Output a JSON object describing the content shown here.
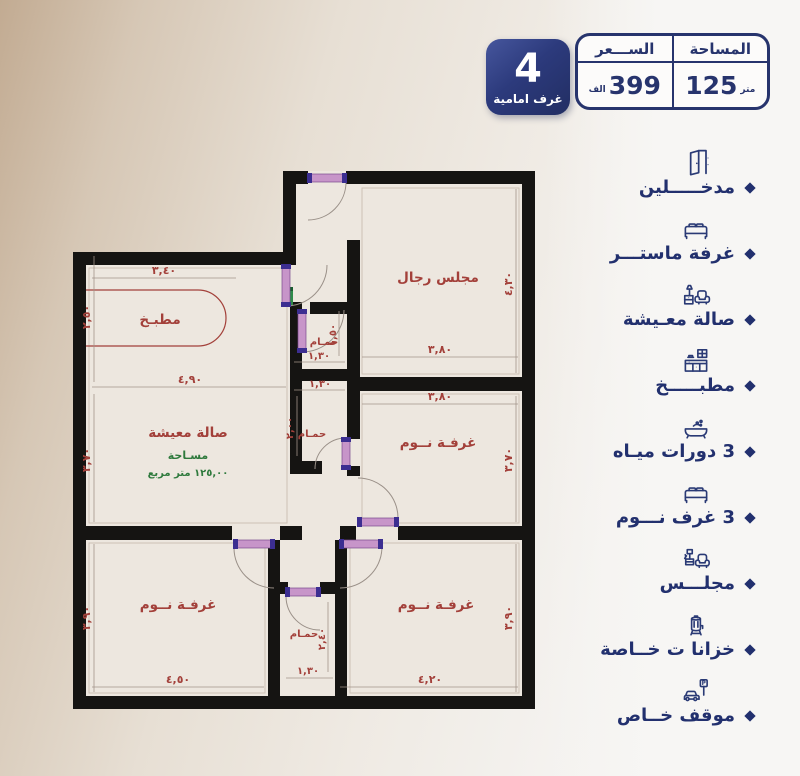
{
  "header": {
    "area": {
      "label": "المساحة",
      "value": "125",
      "unit": "متر"
    },
    "price": {
      "label": "الســـعر",
      "value": "399",
      "unit": "الف"
    },
    "badge": {
      "number": "4",
      "label": "غرف امامية"
    }
  },
  "features": {
    "items": [
      {
        "icon": "door-icon",
        "label": "مدخـــــلين"
      },
      {
        "icon": "bed-icon",
        "label": "غرفة ماستـــر"
      },
      {
        "icon": "living-room-icon",
        "label": "صالة معـيشة"
      },
      {
        "icon": "kitchen-icon",
        "label": "مطبـــــخ"
      },
      {
        "icon": "bathtub-icon",
        "label": "3 دورات ميـاه"
      },
      {
        "icon": "bed-icon",
        "label": "3 غرف نـــوم"
      },
      {
        "icon": "majlis-icon",
        "label": "مجلـــس"
      },
      {
        "icon": "water-tank-icon",
        "label": "خزانا ت خــاصة"
      },
      {
        "icon": "parking-icon",
        "label": "موقف خــاص"
      }
    ]
  },
  "plan": {
    "kitchen": {
      "name": "مطبـخ",
      "w": "٣,٤٠",
      "h": "٢,٥٠"
    },
    "majlis_men": {
      "name": "مجلس رجال",
      "w": "٣,٨٠",
      "h": "٤,٣٠"
    },
    "living": {
      "name": "صالة معيشة",
      "area_label": "مسـاحة",
      "area_value": "١٢٥,٠٠ متر مربع",
      "w": "٤,٩٠",
      "h": "٣,٧٠"
    },
    "bath_top": {
      "name": "حمـام",
      "w": "١,٣٠",
      "h": "١,٥٠"
    },
    "bath_mid": {
      "name": "حمـام",
      "w": "١,٣٠",
      "h": "٢,٠٠"
    },
    "bed_right": {
      "name": "غرفـة نــوم",
      "w": "٣,٨٠",
      "h": "٣,٧٠"
    },
    "bed_bottom_left": {
      "name": "غرفـة نــوم",
      "w": "٤,٥٠",
      "h": "٣,٩٠"
    },
    "bath_bottom": {
      "name": "حمـام",
      "w": "١,٣٠",
      "h": "٢,٤٠"
    },
    "bed_bottom_right": {
      "name": "غرفـة نــوم",
      "w": "٤,٢٠",
      "h": "٣,٩٠"
    }
  },
  "icons": {
    "parking_letter": "P"
  }
}
